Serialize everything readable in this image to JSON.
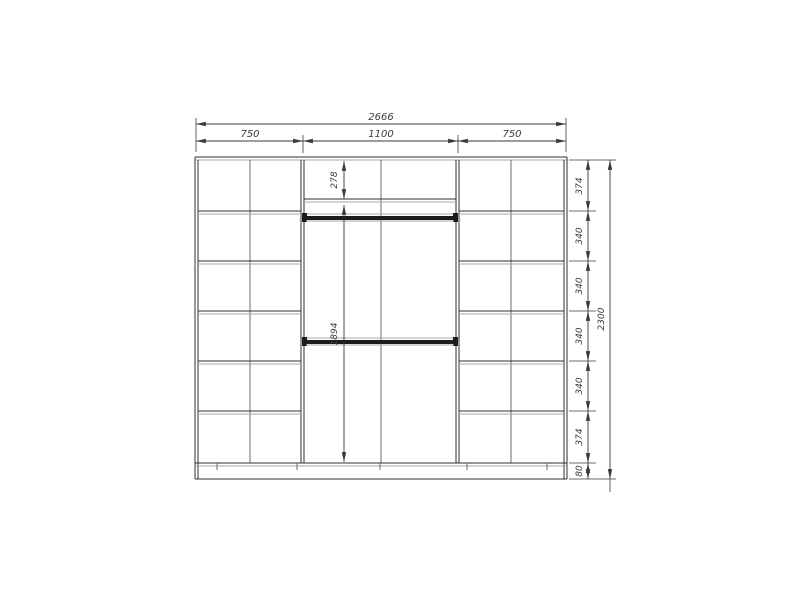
{
  "drawing": {
    "background": "#ffffff",
    "line_color": "#2f2f2f",
    "light_line_color": "#a9a9a9",
    "dim_text_color": "#3a3a3a",
    "dims": {
      "total_width": "2666",
      "sections": [
        "750",
        "1100",
        "750"
      ],
      "total_height": "2300",
      "height_segments": [
        "374",
        "340",
        "340",
        "340",
        "340",
        "374",
        "80"
      ],
      "middle_top_shelf": "278",
      "middle_hanging_space": "1894"
    }
  }
}
